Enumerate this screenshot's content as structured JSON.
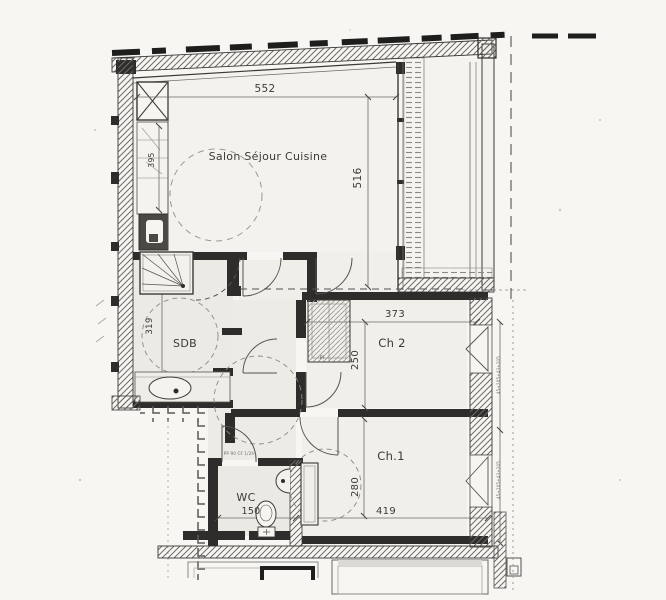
{
  "rooms": {
    "salon": "Salon Séjour Cuisine",
    "sdb": "SDB",
    "ch2": "Ch 2",
    "ch1": "Ch.1",
    "wc": "WC",
    "closet": "Pl"
  },
  "dims": {
    "salon_w": "552",
    "salon_h": "516",
    "kitchen_h": "395",
    "sdb_h": "319",
    "ch2_w": "373",
    "ch2_h": "250",
    "ch1_h": "280",
    "ch1_w": "419",
    "wc_w": "150"
  },
  "annotations": {
    "wc_door": "PP 90 CF 1/2h",
    "right_dim_upper": "45+205+43+205",
    "right_dim_lower": "45+205+43+205"
  },
  "colors": {
    "paper": "#f7f6f3",
    "ink": "#2e2d2b",
    "wall_hatch": "#6b6a66",
    "dim_line": "#6b6a66",
    "text": "#3b3a36"
  }
}
